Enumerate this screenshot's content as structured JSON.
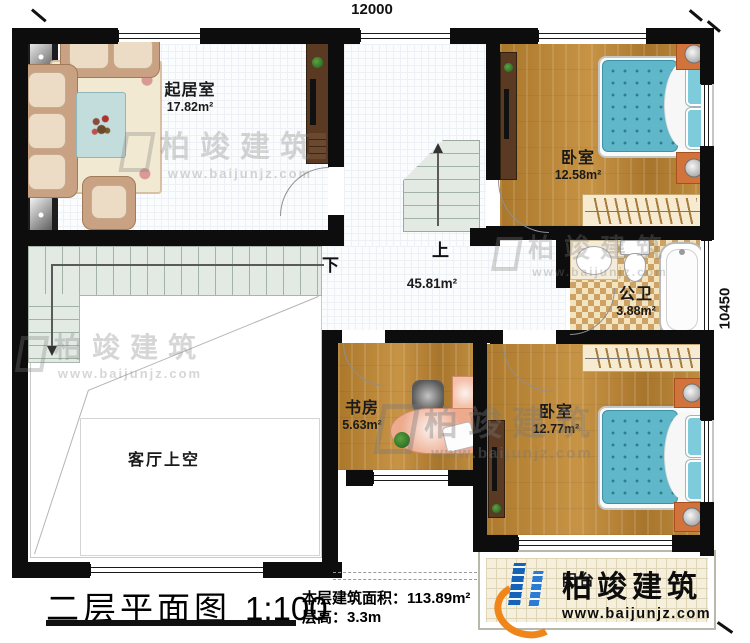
{
  "plan": {
    "dim_top": "12000",
    "dim_right": "10450",
    "rooms": {
      "living": {
        "name": "起居室",
        "area": "17.82m²"
      },
      "bedroom1": {
        "name": "卧室",
        "area": "12.58m²"
      },
      "bathroom": {
        "name": "公卫",
        "area": "3.88m²"
      },
      "study": {
        "name": "书房",
        "area": "5.63m²"
      },
      "bedroom2": {
        "name": "卧室",
        "area": "12.77m²"
      },
      "hall": {
        "area": "45.81m²"
      },
      "void": {
        "name": "客厅上空"
      },
      "balcony": {
        "name": "阳台"
      }
    },
    "stairs": {
      "up": "上",
      "down": "下"
    }
  },
  "footer": {
    "title": "二层平面图",
    "scale": "1:100",
    "area_label": "本层建筑面积：",
    "area_value": "113.89m²",
    "height_label": "层高：",
    "height_value": "3.3m"
  },
  "watermark": {
    "brand": "柏竣建筑",
    "url": "www.baijunjz.com"
  },
  "logo": {
    "brand": "柏竣建筑",
    "url": "www.baijunjz.com"
  },
  "colors": {
    "wall": "#0d0d0d",
    "wood": "#b5822f",
    "mattress": "#5fb7c9",
    "nightstand": "#d2733c",
    "logo_blue": "#1563b8",
    "logo_orange": "#f08519"
  }
}
